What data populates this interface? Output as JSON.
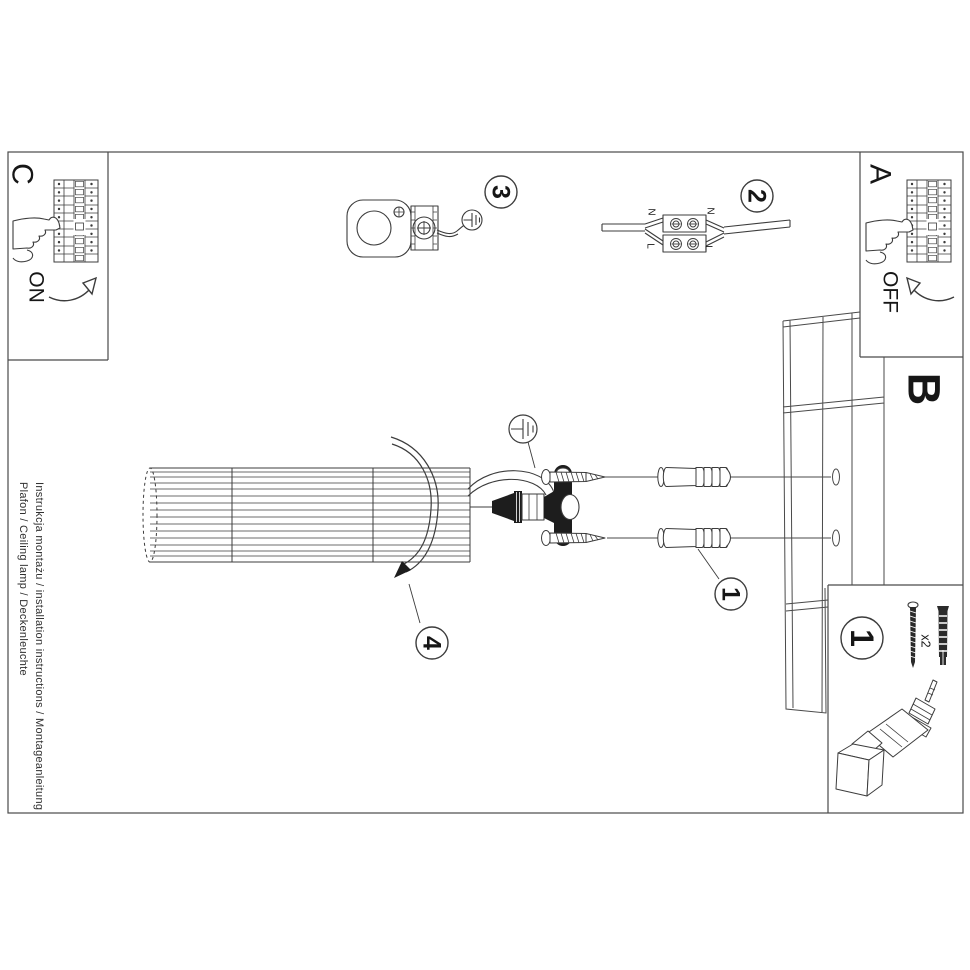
{
  "document": {
    "type": "installation-instruction-sheet",
    "side_text": {
      "line1": "Instrukcja montażu / installation instructions / Montageanleitung",
      "line2": "Plafon / Ceiling lamp / Deckenleuchte"
    }
  },
  "sections": {
    "power_on": {
      "label": "C",
      "state": "ON"
    },
    "power_off": {
      "label": "A",
      "state": "OFF"
    },
    "ceiling": {
      "label": "B"
    }
  },
  "steps": {
    "step1": "1",
    "step2": "2",
    "step3": "3",
    "step4": "4"
  },
  "wiring": {
    "neutral": "N",
    "live": "L"
  },
  "parts": {
    "badge": "1",
    "screw_qty": "x2"
  },
  "colors": {
    "background": "#ffffff",
    "ink": "#3c3c3c",
    "text": "#161616",
    "solid_fill": "#1d1d1d"
  }
}
